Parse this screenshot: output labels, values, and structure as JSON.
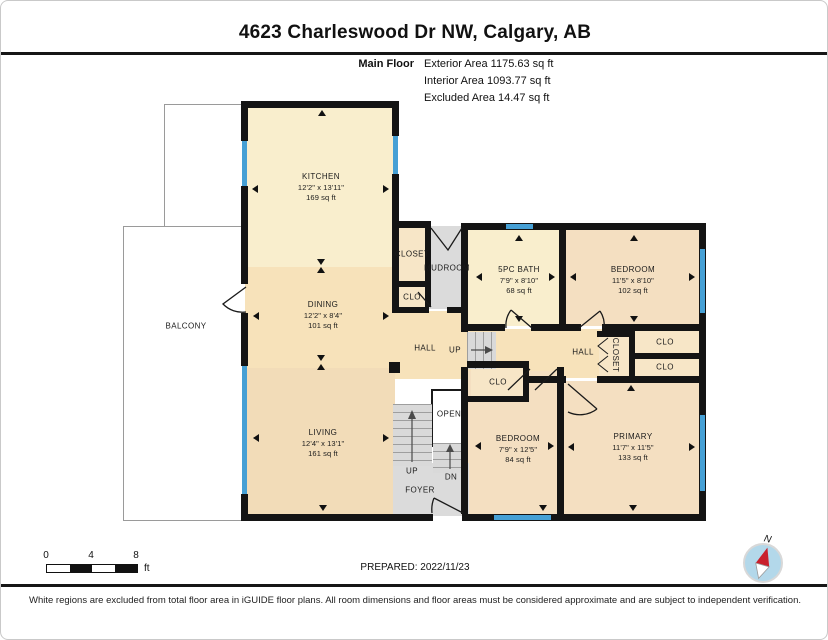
{
  "title": "4623 Charleswood Dr NW, Calgary, AB",
  "header": {
    "floor_label": "Main Floor",
    "areas": [
      {
        "label": "Exterior Area",
        "value": "1175.63 sq ft"
      },
      {
        "label": "Interior Area",
        "value": "1093.77 sq ft"
      },
      {
        "label": "Excluded Area",
        "value": "14.47 sq ft"
      }
    ]
  },
  "plan": {
    "colors": {
      "cream": "#f9eecd",
      "tanMid": "#f7e2ba",
      "tanDeep": "#f2dcb8",
      "tanRoom": "#f4dfc1",
      "closet": "#f7e6c7",
      "gray": "#dbdbdb",
      "white": "#ffffff",
      "wall": "#141414",
      "window": "#46a0d5"
    },
    "regions": [
      {
        "n": "balcony-upper",
        "x": 163,
        "y": 103,
        "w": 80,
        "h": 124,
        "f": "white",
        "b": "balcony"
      },
      {
        "n": "balcony",
        "x": 122,
        "y": 225,
        "w": 121,
        "h": 293,
        "f": "white",
        "b": "balcony"
      },
      {
        "n": "kitchen",
        "x": 244,
        "y": 104,
        "w": 150,
        "h": 166,
        "f": "cream"
      },
      {
        "n": "dining",
        "x": 244,
        "y": 266,
        "w": 150,
        "h": 101,
        "f": "tanMid"
      },
      {
        "n": "living",
        "x": 244,
        "y": 367,
        "w": 150,
        "h": 149,
        "f": "tanDeep"
      },
      {
        "n": "hall-west",
        "x": 394,
        "y": 310,
        "w": 70,
        "h": 68,
        "f": "tanMid"
      },
      {
        "n": "hall-east",
        "x": 462,
        "y": 328,
        "w": 140,
        "h": 49,
        "f": "tanMid"
      },
      {
        "n": "mudroom",
        "x": 428,
        "y": 225,
        "w": 34,
        "h": 83,
        "f": "gray"
      },
      {
        "n": "closet-mudroom",
        "x": 396,
        "y": 225,
        "w": 30,
        "h": 57,
        "f": "closet"
      },
      {
        "n": "clo-mudroom",
        "x": 396,
        "y": 284,
        "w": 30,
        "h": 24,
        "f": "closet"
      },
      {
        "n": "bath",
        "x": 465,
        "y": 227,
        "w": 95,
        "h": 98,
        "f": "cream"
      },
      {
        "n": "bedroom-north",
        "x": 563,
        "y": 227,
        "w": 137,
        "h": 98,
        "f": "tanRoom"
      },
      {
        "n": "bedroom-south",
        "x": 465,
        "y": 370,
        "w": 93,
        "h": 145,
        "f": "tanRoom"
      },
      {
        "n": "primary",
        "x": 561,
        "y": 380,
        "w": 139,
        "h": 135,
        "f": "tanRoom"
      },
      {
        "n": "closet-hall",
        "x": 598,
        "y": 334,
        "w": 32,
        "h": 43,
        "f": "closet"
      },
      {
        "n": "clo-east-1",
        "x": 632,
        "y": 328,
        "w": 68,
        "h": 26,
        "f": "closet"
      },
      {
        "n": "clo-east-2",
        "x": 632,
        "y": 356,
        "w": 68,
        "h": 21,
        "f": "closet"
      },
      {
        "n": "clo-bedroom-south",
        "x": 470,
        "y": 365,
        "w": 56,
        "h": 32,
        "f": "closet"
      },
      {
        "n": "foyer",
        "x": 392,
        "y": 462,
        "w": 76,
        "h": 53,
        "f": "gray"
      },
      {
        "n": "stair-opening",
        "x": 430,
        "y": 388,
        "w": 32,
        "h": 54,
        "f": "white",
        "b": "open"
      }
    ],
    "stairs": [
      {
        "n": "stairs-main-up",
        "x": 392,
        "y": 403,
        "w": 39,
        "h": 62,
        "dir": "h"
      },
      {
        "n": "stairs-down",
        "x": 432,
        "y": 442,
        "w": 30,
        "h": 30,
        "dir": "h"
      },
      {
        "n": "stairs-up-small",
        "x": 466,
        "y": 331,
        "w": 29,
        "h": 37,
        "dir": "v"
      }
    ],
    "walls": [
      [
        240,
        100,
        158,
        7
      ],
      [
        240,
        100,
        7,
        40
      ],
      [
        240,
        185,
        7,
        98
      ],
      [
        240,
        312,
        7,
        53
      ],
      [
        240,
        493,
        7,
        27
      ],
      [
        240,
        513,
        192,
        7
      ],
      [
        461,
        513,
        244,
        7
      ],
      [
        391,
        100,
        7,
        35
      ],
      [
        391,
        173,
        7,
        139
      ],
      [
        391,
        220,
        39,
        7
      ],
      [
        460,
        222,
        245,
        7
      ],
      [
        698,
        229,
        7,
        291
      ],
      [
        558,
        229,
        7,
        101
      ],
      [
        460,
        229,
        7,
        102
      ],
      [
        460,
        323,
        44,
        7
      ],
      [
        530,
        323,
        50,
        7
      ],
      [
        601,
        323,
        104,
        7
      ],
      [
        396,
        280,
        30,
        6
      ],
      [
        396,
        306,
        32,
        6
      ],
      [
        446,
        306,
        16,
        6
      ],
      [
        424,
        227,
        6,
        79
      ],
      [
        460,
        366,
        7,
        147
      ],
      [
        466,
        360,
        62,
        7
      ],
      [
        466,
        395,
        62,
        6
      ],
      [
        522,
        364,
        6,
        33
      ],
      [
        556,
        366,
        7,
        147
      ],
      [
        528,
        375,
        37,
        7
      ],
      [
        596,
        375,
        109,
        7
      ],
      [
        596,
        330,
        38,
        6
      ],
      [
        628,
        330,
        6,
        51
      ],
      [
        634,
        352,
        66,
        6
      ],
      [
        388,
        361,
        11,
        11
      ]
    ],
    "windows": [
      [
        241,
        140,
        5,
        45
      ],
      [
        392,
        135,
        5,
        38
      ],
      [
        241,
        365,
        5,
        128
      ],
      [
        505,
        223,
        27,
        5
      ],
      [
        699,
        248,
        5,
        64
      ],
      [
        699,
        414,
        5,
        76
      ],
      [
        493,
        514,
        57,
        5
      ]
    ],
    "labels": [
      {
        "lines": [
          "KITCHEN",
          "12'2\" x 13'11\"",
          "169 sq ft"
        ],
        "x": 320,
        "y": 186
      },
      {
        "lines": [
          "DINING",
          "12'2\" x 8'4\"",
          "101 sq ft"
        ],
        "x": 322,
        "y": 314
      },
      {
        "lines": [
          "LIVING",
          "12'4\" x 13'1\"",
          "161 sq ft"
        ],
        "x": 322,
        "y": 442
      },
      {
        "lines": [
          "BALCONY"
        ],
        "x": 185,
        "y": 325
      },
      {
        "lines": [
          "MUDROOM"
        ],
        "x": 446,
        "y": 267
      },
      {
        "lines": [
          "CLOSET"
        ],
        "x": 411,
        "y": 253
      },
      {
        "lines": [
          "CLO"
        ],
        "x": 411,
        "y": 296
      },
      {
        "lines": [
          "5PC BATH",
          "7'9\" x 8'10\"",
          "68 sq ft"
        ],
        "x": 518,
        "y": 279
      },
      {
        "lines": [
          "BEDROOM",
          "11'5\" x 8'10\"",
          "102 sq ft"
        ],
        "x": 632,
        "y": 279
      },
      {
        "lines": [
          "HALL"
        ],
        "x": 424,
        "y": 347
      },
      {
        "lines": [
          "UP"
        ],
        "x": 454,
        "y": 349
      },
      {
        "lines": [
          "HALL"
        ],
        "x": 582,
        "y": 351
      },
      {
        "lines": [
          "CLOSET"
        ],
        "x": 614,
        "y": 354,
        "rot": 90
      },
      {
        "lines": [
          "CLO"
        ],
        "x": 664,
        "y": 341
      },
      {
        "lines": [
          "CLO"
        ],
        "x": 664,
        "y": 366
      },
      {
        "lines": [
          "CLO"
        ],
        "x": 497,
        "y": 381
      },
      {
        "lines": [
          "OPEN"
        ],
        "x": 448,
        "y": 413
      },
      {
        "lines": [
          "UP"
        ],
        "x": 411,
        "y": 470
      },
      {
        "lines": [
          "DN"
        ],
        "x": 450,
        "y": 476
      },
      {
        "lines": [
          "FOYER"
        ],
        "x": 419,
        "y": 489
      },
      {
        "lines": [
          "BEDROOM",
          "7'9\" x 12'5\"",
          "84 sq ft"
        ],
        "x": 517,
        "y": 448
      },
      {
        "lines": [
          "PRIMARY",
          "11'7\" x 11'5\"",
          "133 sq ft"
        ],
        "x": 632,
        "y": 446
      }
    ],
    "arrows": [
      {
        "x": 321,
        "y": 112,
        "d": "up"
      },
      {
        "x": 254,
        "y": 188,
        "d": "left"
      },
      {
        "x": 385,
        "y": 188,
        "d": "right"
      },
      {
        "x": 320,
        "y": 261,
        "d": "down"
      },
      {
        "x": 320,
        "y": 269,
        "d": "up"
      },
      {
        "x": 255,
        "y": 315,
        "d": "left"
      },
      {
        "x": 385,
        "y": 315,
        "d": "right"
      },
      {
        "x": 320,
        "y": 357,
        "d": "down"
      },
      {
        "x": 320,
        "y": 366,
        "d": "up"
      },
      {
        "x": 255,
        "y": 437,
        "d": "left"
      },
      {
        "x": 385,
        "y": 437,
        "d": "right"
      },
      {
        "x": 322,
        "y": 507,
        "d": "down"
      },
      {
        "x": 518,
        "y": 237,
        "d": "up"
      },
      {
        "x": 478,
        "y": 276,
        "d": "left"
      },
      {
        "x": 551,
        "y": 276,
        "d": "right"
      },
      {
        "x": 518,
        "y": 318,
        "d": "down"
      },
      {
        "x": 633,
        "y": 237,
        "d": "up"
      },
      {
        "x": 572,
        "y": 276,
        "d": "left"
      },
      {
        "x": 691,
        "y": 276,
        "d": "right"
      },
      {
        "x": 633,
        "y": 318,
        "d": "down"
      },
      {
        "x": 477,
        "y": 445,
        "d": "left"
      },
      {
        "x": 550,
        "y": 445,
        "d": "right"
      },
      {
        "x": 542,
        "y": 507,
        "d": "down"
      },
      {
        "x": 630,
        "y": 387,
        "d": "up"
      },
      {
        "x": 570,
        "y": 446,
        "d": "left"
      },
      {
        "x": 691,
        "y": 446,
        "d": "right"
      },
      {
        "x": 632,
        "y": 507,
        "d": "down"
      }
    ]
  },
  "scale_bar": {
    "ticks": [
      "0",
      "4",
      "8"
    ],
    "unit": "ft"
  },
  "prepared_label": "PREPARED: 2022/11/23",
  "compass": {
    "label": "N"
  },
  "footer": "White regions are excluded from total floor area in iGUIDE floor plans. All room dimensions and floor areas must be considered approximate and are subject to independent verification."
}
